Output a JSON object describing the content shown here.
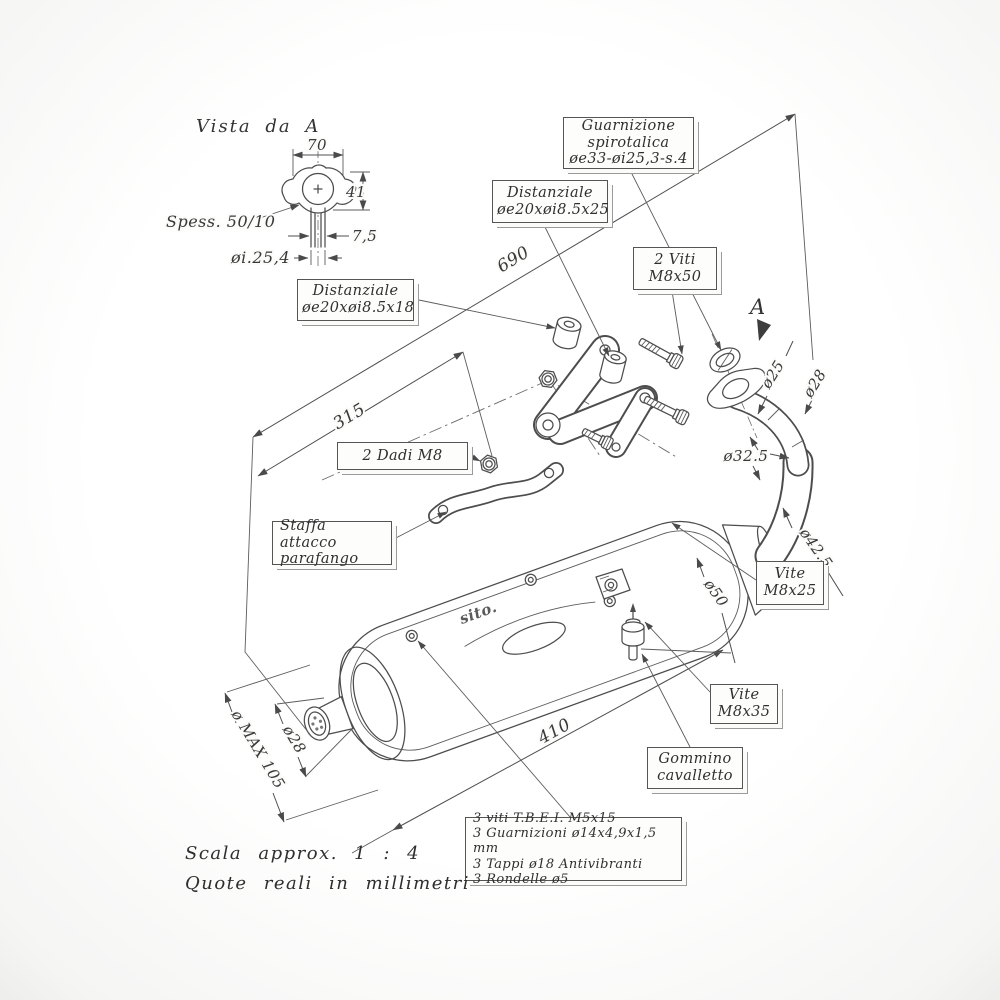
{
  "drawing": {
    "view_label": "Vista da A",
    "view_arrow_label": "A",
    "brand_logo": "sito.",
    "line_color": "#4d4d4d",
    "text_color": "#383838",
    "background": "#ffffff"
  },
  "detail_view": {
    "width": "70",
    "height": "41",
    "offset": "7,5",
    "thickness": "Spess. 50/10",
    "inner_diameter": "øi.25,4"
  },
  "dimensions": {
    "overall_length": "690",
    "bracket_distance": "315",
    "body_length": "410",
    "max_diameter": "ø MAX 105",
    "tail_tip_diameter": "ø28",
    "body_inlet_diameter": "ø50",
    "bend_diameter": "ø42.5",
    "mid_pipe_diameter": "ø32.5",
    "header_diameter": "ø25",
    "header_outer_diameter": "ø28"
  },
  "callouts": {
    "guarnizione": {
      "lines": [
        "Guarnizione",
        "spirotalica",
        "øe33-øi25,3-s.4"
      ]
    },
    "distanziale_25": {
      "lines": [
        "Distanziale",
        "øe20xøi8.5x25"
      ]
    },
    "viti_m8x50": {
      "lines": [
        "2 Viti",
        "M8x50"
      ]
    },
    "distanziale_18": {
      "lines": [
        "Distanziale",
        "øe20xøi8.5x18"
      ]
    },
    "dadi_m8": {
      "lines": [
        "2 Dadi M8"
      ]
    },
    "staffa": {
      "lines": [
        "Staffa attacco",
        "parafango"
      ]
    },
    "vite_m8x25": {
      "lines": [
        "Vite",
        "M8x25"
      ]
    },
    "vite_m8x35": {
      "lines": [
        "Vite",
        "M8x35"
      ]
    },
    "gommino": {
      "lines": [
        "Gommino",
        "cavalletto"
      ]
    },
    "parts_list": {
      "lines": [
        "3 viti T.B.E.I. M5x15",
        "3 Guarnizioni ø14x4,9x1,5 mm",
        "3 Tappi ø18 Antivibranti",
        "3 Rondelle ø5"
      ]
    }
  },
  "footer": {
    "scale_note": "Scala approx. 1 : 4",
    "units_note": "Quote reali in millimetri"
  }
}
